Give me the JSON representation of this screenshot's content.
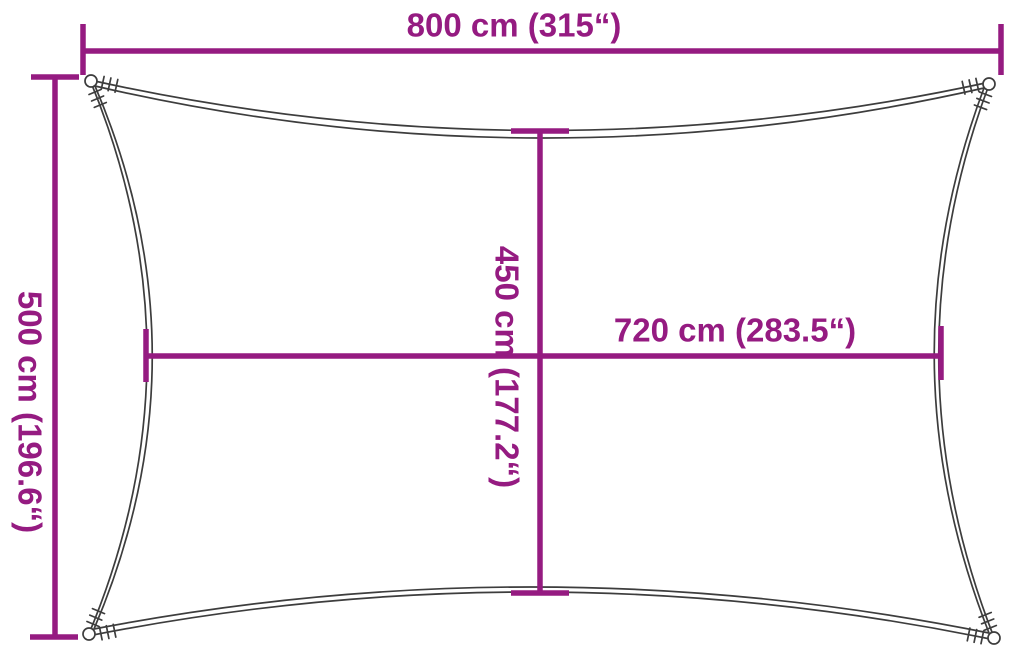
{
  "diagram": {
    "title": "shade-sail-dimension-diagram",
    "shape": "rectangle-with-concave-edges",
    "colors": {
      "dimension": "#951B81",
      "outline": "#3D3D3D",
      "background": "#FFFFFF"
    },
    "dimensions": {
      "overall_width": {
        "label": "800 cm (315“)",
        "orientation": "horizontal",
        "position": "top"
      },
      "overall_height": {
        "label": "500 cm (196.6“)",
        "orientation": "vertical",
        "position": "left"
      },
      "inner_height": {
        "label": "450 cm (177.2“)",
        "orientation": "vertical",
        "position": "center"
      },
      "inner_width": {
        "label": "720 cm (283.5“)",
        "orientation": "horizontal",
        "position": "center-right"
      }
    }
  }
}
